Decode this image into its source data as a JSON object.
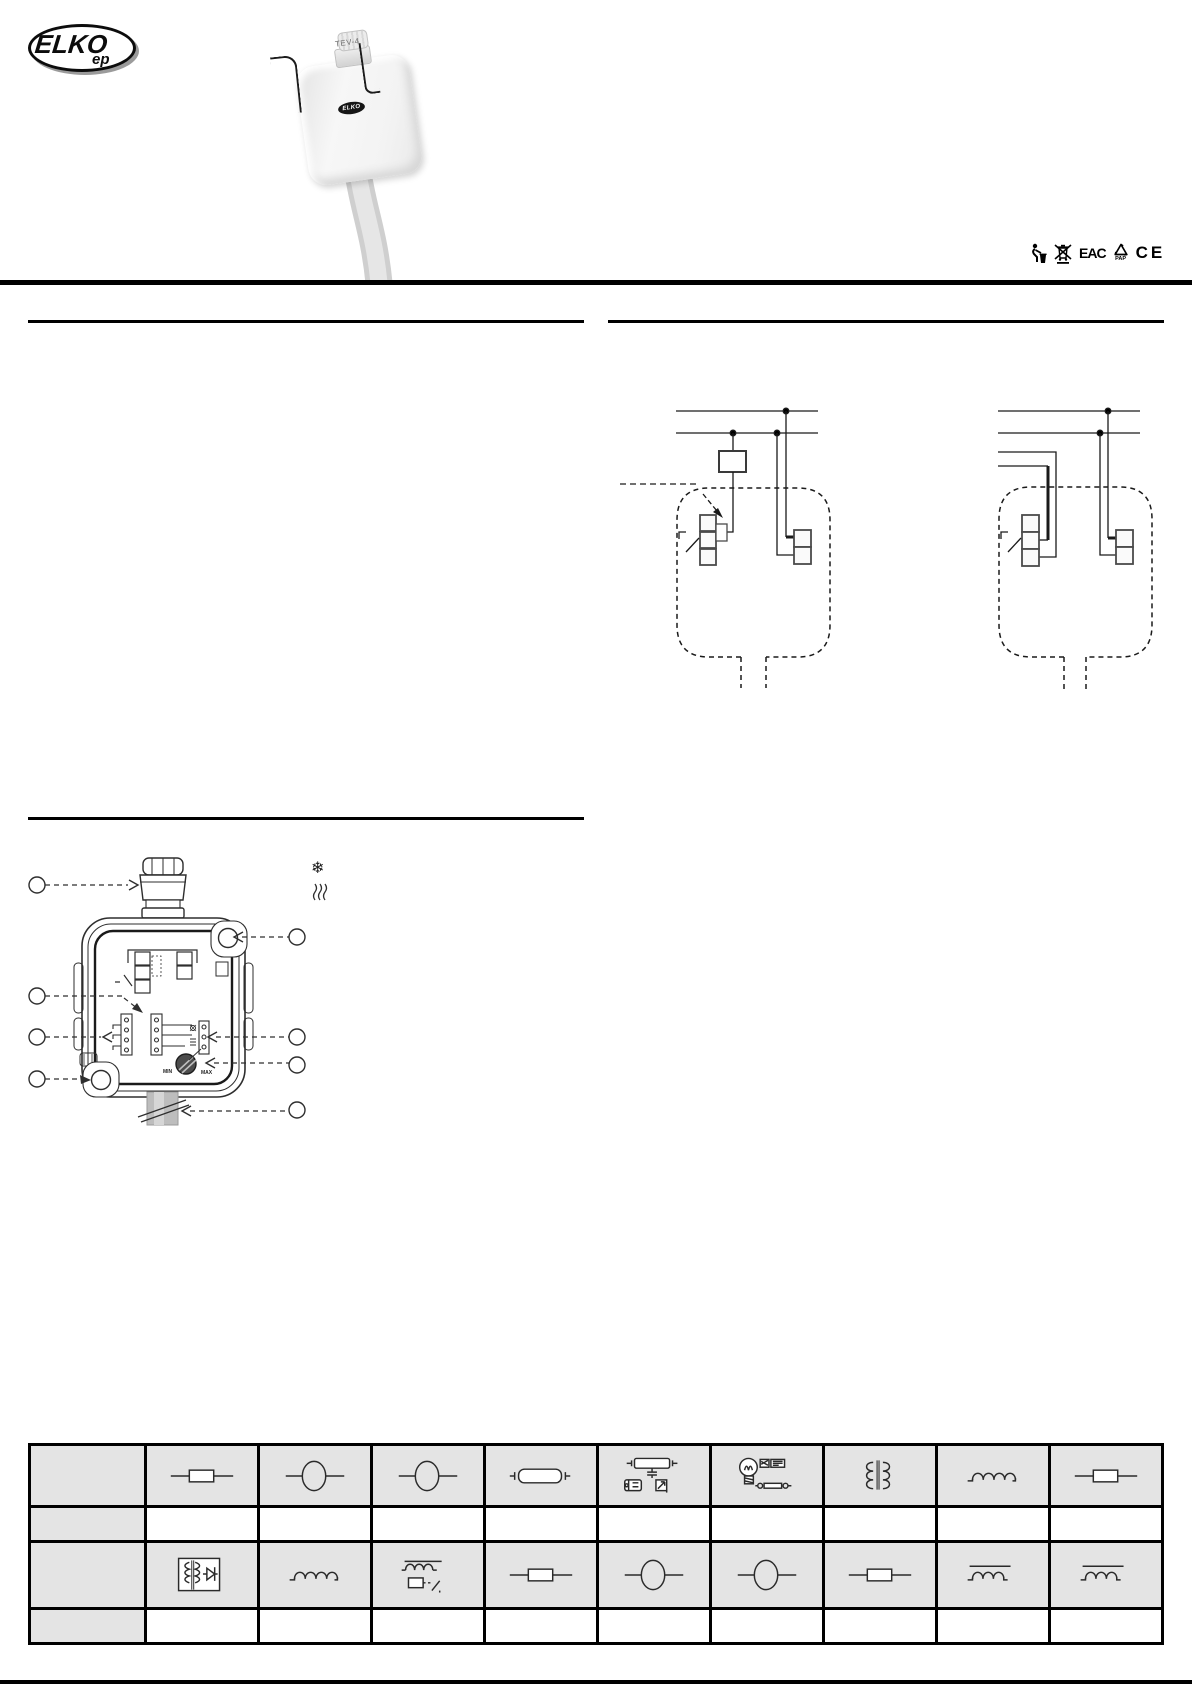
{
  "brand": {
    "name": "ELKO",
    "sub": "ep"
  },
  "product": {
    "model": "TEV-4",
    "badge": "ELKO"
  },
  "cert": {
    "icons": [
      "tidy-man-icon",
      "weee-crossed-bin-icon",
      "eac-icon",
      "pap-recycle-icon",
      "ce-icon"
    ],
    "eac": "EAC",
    "pap": "PAP",
    "ce": "CE"
  },
  "legend": {
    "cooling_glyph": "❄",
    "icons": [
      "snowflake-icon",
      "heat-waves-icon"
    ]
  },
  "figure": {
    "min": "MIN",
    "max": "MAX",
    "callouts_left": 4,
    "callouts_right": 4
  },
  "wiring": {
    "diagrams": [
      "wiring-example-1",
      "wiring-example-2"
    ]
  },
  "load_table": {
    "columns": 10,
    "rows": [
      {
        "kind": "symbols",
        "cells": [
          null,
          "resistive-load",
          "incandescent-lamp",
          "halogen-lamp",
          "fluorescent-tube",
          "compensated-fluorescent-lamp",
          "led-esl-lamp",
          "wound-transformer",
          "inductive-load",
          "resistive-load"
        ]
      },
      {
        "kind": "values",
        "cells": [
          null,
          "",
          "",
          "",
          "",
          "",
          "",
          "",
          "",
          ""
        ]
      },
      {
        "kind": "symbols",
        "cells": [
          null,
          "electronic-transformer",
          "inductive-load",
          "relay-coil-load",
          "resistive-load",
          "incandescent-lamp",
          "halogen-lamp",
          "resistive-load",
          "inductive-load-overline",
          "inductive-load-overline"
        ]
      },
      {
        "kind": "values",
        "cells": [
          null,
          "",
          "",
          "",
          "",
          "",
          "",
          "",
          "",
          ""
        ]
      }
    ]
  }
}
